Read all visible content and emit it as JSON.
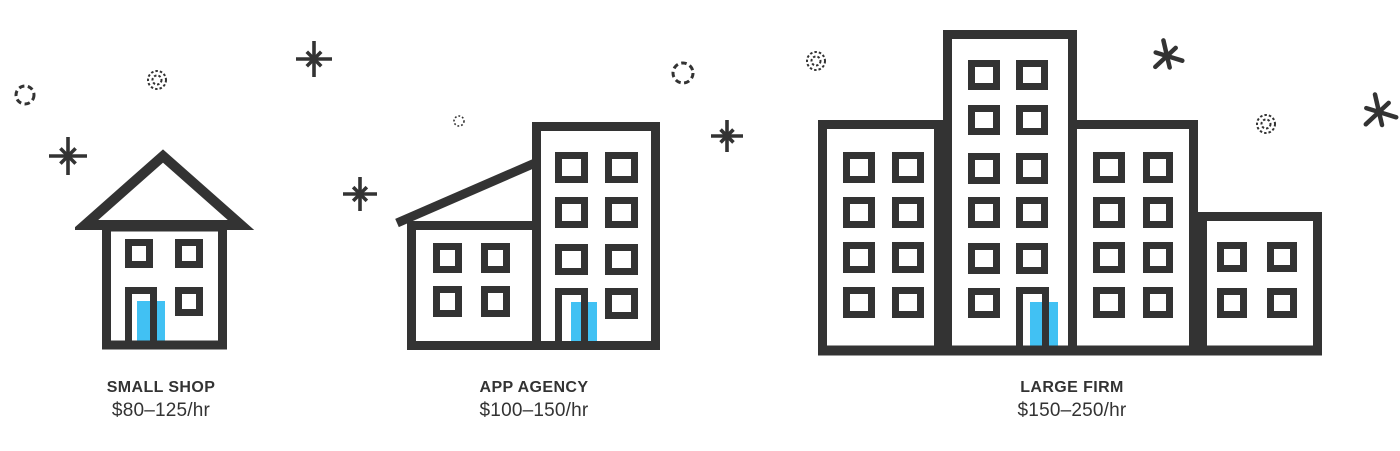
{
  "colors": {
    "ink": "#333333",
    "accent": "#41c1f3",
    "background": "#ffffff"
  },
  "tiers": [
    {
      "label": "SMALL SHOP",
      "rate": "$80–125/hr",
      "icon": "small-house-icon"
    },
    {
      "label": "APP AGENCY",
      "rate": "$100–150/hr",
      "icon": "mid-buildings-icon"
    },
    {
      "label": "LARGE FIRM",
      "rate": "$150–250/hr",
      "icon": "large-buildings-icon"
    }
  ],
  "decorations": [
    {
      "type": "circle-dashed",
      "x": 25,
      "y": 95,
      "r": 9
    },
    {
      "type": "circle-double-dotted",
      "x": 157,
      "y": 80,
      "r": 9
    },
    {
      "type": "sparkle",
      "x": 314,
      "y": 59,
      "size": 38
    },
    {
      "type": "sparkle",
      "x": 68,
      "y": 156,
      "size": 40
    },
    {
      "type": "circle-dotted-small",
      "x": 459,
      "y": 121,
      "r": 5
    },
    {
      "type": "sparkle",
      "x": 360,
      "y": 194,
      "size": 36
    },
    {
      "type": "circle-dashed",
      "x": 683,
      "y": 73,
      "r": 10
    },
    {
      "type": "sparkle",
      "x": 727,
      "y": 136,
      "size": 34
    },
    {
      "type": "circle-double-dotted",
      "x": 816,
      "y": 61,
      "r": 9
    },
    {
      "type": "asterisk",
      "x": 1167,
      "y": 56,
      "size": 36
    },
    {
      "type": "circle-double-dotted",
      "x": 1266,
      "y": 124,
      "r": 9
    },
    {
      "type": "asterisk",
      "x": 1379,
      "y": 112,
      "size": 40
    }
  ]
}
